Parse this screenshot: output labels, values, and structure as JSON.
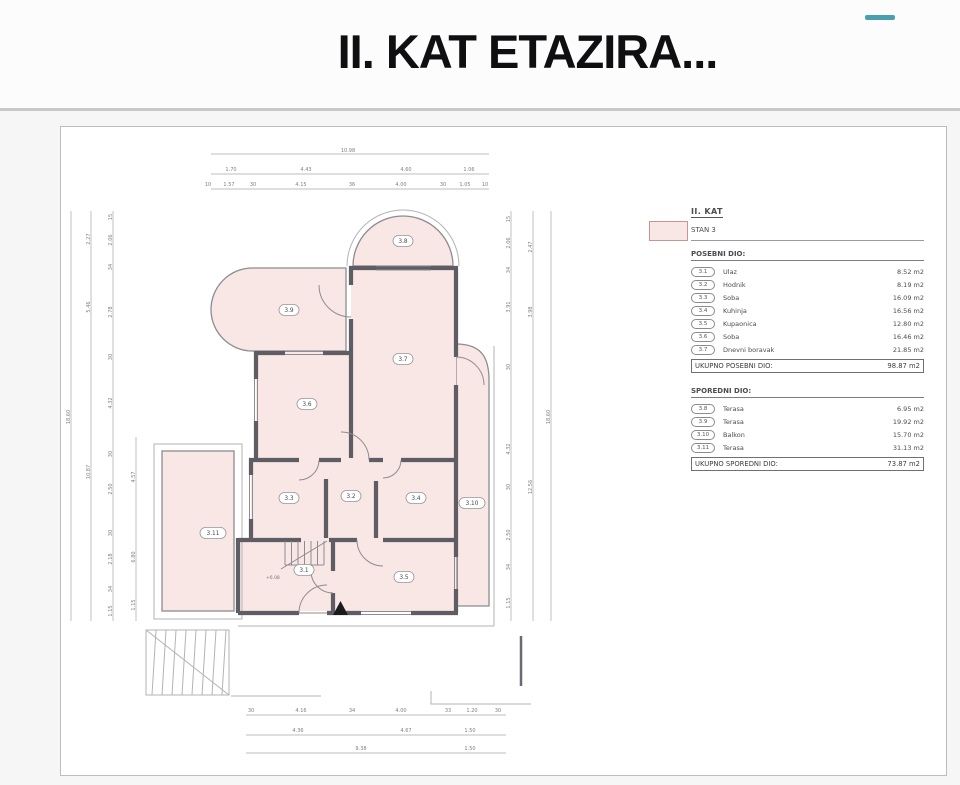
{
  "title": "II. KAT ETAZIRA...",
  "accent_dash_color": "#4a9fae",
  "legend": {
    "floor_label": "II. KAT",
    "unit_label": "STAN 3",
    "swatch_color": "#f8e7e4",
    "sections": [
      {
        "heading": "POSEBNI DIO:",
        "rows": [
          {
            "badge": "3.1",
            "name": "Ulaz",
            "area": "8.52 m2"
          },
          {
            "badge": "3.2",
            "name": "Hodnik",
            "area": "8.19 m2"
          },
          {
            "badge": "3.3",
            "name": "Soba",
            "area": "16.09 m2"
          },
          {
            "badge": "3.4",
            "name": "Kuhinja",
            "area": "16.56 m2"
          },
          {
            "badge": "3.5",
            "name": "Kupaonica",
            "area": "12.80 m2"
          },
          {
            "badge": "3.6",
            "name": "Soba",
            "area": "16.46 m2"
          },
          {
            "badge": "3.7",
            "name": "Dnevni boravak",
            "area": "21.85 m2"
          }
        ],
        "total_label": "UKUPNO POSEBNI DIO:",
        "total_value": "98.87 m2"
      },
      {
        "heading": "SPOREDNI DIO:",
        "rows": [
          {
            "badge": "3.8",
            "name": "Terasa",
            "area": "6.95 m2"
          },
          {
            "badge": "3.9",
            "name": "Terasa",
            "area": "19.92 m2"
          },
          {
            "badge": "3.10",
            "name": "Balkon",
            "area": "15.70 m2"
          },
          {
            "badge": "3.11",
            "name": "Terasa",
            "area": "31.13 m2"
          }
        ],
        "total_label": "UKUPNO SPOREDNI DIO:",
        "total_value": "73.87 m2"
      }
    ]
  },
  "plan": {
    "colors": {
      "room_fill": "#f8e7e4",
      "wall": "#5d5d63"
    },
    "level_note": "+6.08",
    "room_labels": [
      {
        "t": "3.1",
        "x": 243,
        "y": 443
      },
      {
        "t": "3.2",
        "x": 290,
        "y": 369
      },
      {
        "t": "3.3",
        "x": 228,
        "y": 371
      },
      {
        "t": "3.4",
        "x": 355,
        "y": 371
      },
      {
        "t": "3.5",
        "x": 343,
        "y": 450
      },
      {
        "t": "3.6",
        "x": 246,
        "y": 277
      },
      {
        "t": "3.7",
        "x": 342,
        "y": 232
      },
      {
        "t": "3.8",
        "x": 342,
        "y": 114
      },
      {
        "t": "3.9",
        "x": 228,
        "y": 183
      },
      {
        "t": "3.10",
        "x": 411,
        "y": 376
      },
      {
        "t": "3.11",
        "x": 152,
        "y": 406
      }
    ],
    "dim_labels": [
      {
        "t": "10.98",
        "x": 287,
        "y": 25
      },
      {
        "t": "1.70",
        "x": 170,
        "y": 44
      },
      {
        "t": "4.43",
        "x": 245,
        "y": 44
      },
      {
        "t": "4.60",
        "x": 345,
        "y": 44
      },
      {
        "t": "1.06",
        "x": 408,
        "y": 44
      },
      {
        "t": "10",
        "x": 147,
        "y": 59
      },
      {
        "t": "1.57",
        "x": 168,
        "y": 59
      },
      {
        "t": "30",
        "x": 192,
        "y": 59
      },
      {
        "t": "4.15",
        "x": 240,
        "y": 59
      },
      {
        "t": "36",
        "x": 291,
        "y": 59
      },
      {
        "t": "4.00",
        "x": 340,
        "y": 59
      },
      {
        "t": "30",
        "x": 382,
        "y": 59
      },
      {
        "t": "1.05",
        "x": 404,
        "y": 59
      },
      {
        "t": "10",
        "x": 424,
        "y": 59
      },
      {
        "t": "18.60",
        "x": 9,
        "y": 290,
        "r": -90
      },
      {
        "t": "2.27",
        "x": 29,
        "y": 112,
        "r": -90
      },
      {
        "t": "5.46",
        "x": 29,
        "y": 180,
        "r": -90
      },
      {
        "t": "10.87",
        "x": 29,
        "y": 345,
        "r": -90
      },
      {
        "t": "15",
        "x": 51,
        "y": 90,
        "r": -90
      },
      {
        "t": "2.06",
        "x": 51,
        "y": 113,
        "r": -90
      },
      {
        "t": "34",
        "x": 51,
        "y": 140,
        "r": -90
      },
      {
        "t": "2.78",
        "x": 51,
        "y": 185,
        "r": -90
      },
      {
        "t": "30",
        "x": 51,
        "y": 230,
        "r": -90
      },
      {
        "t": "4.32",
        "x": 51,
        "y": 276,
        "r": -90
      },
      {
        "t": "30",
        "x": 51,
        "y": 327,
        "r": -90
      },
      {
        "t": "2.50",
        "x": 51,
        "y": 362,
        "r": -90
      },
      {
        "t": "30",
        "x": 51,
        "y": 406,
        "r": -90
      },
      {
        "t": "2.18",
        "x": 51,
        "y": 432,
        "r": -90
      },
      {
        "t": "34",
        "x": 51,
        "y": 462,
        "r": -90
      },
      {
        "t": "1.15",
        "x": 51,
        "y": 484,
        "r": -90
      },
      {
        "t": "4.57",
        "x": 74,
        "y": 350,
        "r": -90
      },
      {
        "t": "6.80",
        "x": 74,
        "y": 430,
        "r": -90
      },
      {
        "t": "1.15",
        "x": 74,
        "y": 478,
        "r": -90
      },
      {
        "t": "15",
        "x": 449,
        "y": 92,
        "r": -90
      },
      {
        "t": "2.06",
        "x": 449,
        "y": 116,
        "r": -90
      },
      {
        "t": "34",
        "x": 449,
        "y": 143,
        "r": -90
      },
      {
        "t": "3.91",
        "x": 449,
        "y": 180,
        "r": -90
      },
      {
        "t": "30",
        "x": 449,
        "y": 240,
        "r": -90
      },
      {
        "t": "4.32",
        "x": 449,
        "y": 322,
        "r": -90
      },
      {
        "t": "30",
        "x": 449,
        "y": 360,
        "r": -90
      },
      {
        "t": "2.50",
        "x": 449,
        "y": 408,
        "r": -90
      },
      {
        "t": "34",
        "x": 449,
        "y": 440,
        "r": -90
      },
      {
        "t": "1.15",
        "x": 449,
        "y": 476,
        "r": -90
      },
      {
        "t": "2.47",
        "x": 471,
        "y": 120,
        "r": -90
      },
      {
        "t": "3.98",
        "x": 471,
        "y": 185,
        "r": -90
      },
      {
        "t": "12.56",
        "x": 471,
        "y": 360,
        "r": -90
      },
      {
        "t": "18.60",
        "x": 489,
        "y": 290,
        "r": -90
      },
      {
        "t": "30",
        "x": 190,
        "y": 585
      },
      {
        "t": "4.16",
        "x": 240,
        "y": 585
      },
      {
        "t": "34",
        "x": 291,
        "y": 585
      },
      {
        "t": "4.00",
        "x": 340,
        "y": 585
      },
      {
        "t": "33",
        "x": 387,
        "y": 585
      },
      {
        "t": "1.20",
        "x": 411,
        "y": 585
      },
      {
        "t": "30",
        "x": 437,
        "y": 585
      },
      {
        "t": "4.36",
        "x": 237,
        "y": 605
      },
      {
        "t": "4.67",
        "x": 345,
        "y": 605
      },
      {
        "t": "1.50",
        "x": 409,
        "y": 605
      },
      {
        "t": "9.38",
        "x": 300,
        "y": 623
      },
      {
        "t": "1.50",
        "x": 409,
        "y": 623
      }
    ]
  }
}
